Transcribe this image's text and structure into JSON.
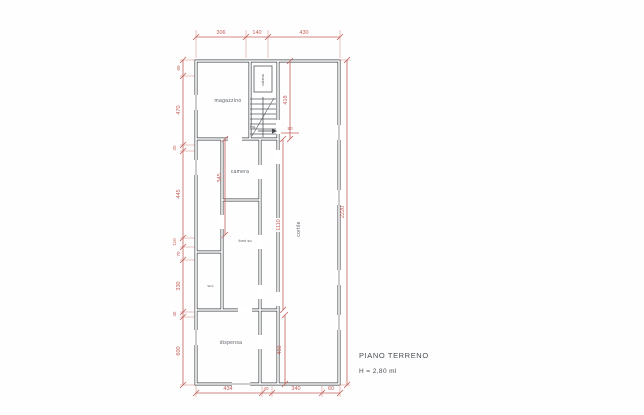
{
  "drawing": {
    "title": "PIANO TERRENO",
    "subtitle": "H = 2,80 ml",
    "rooms": {
      "magazzino": "magazzino",
      "cabina": "cabina",
      "ingresso": "ing.",
      "camera": "camera",
      "forni": "forni so",
      "cortile": "cortile",
      "wc": "w.c.",
      "dispensa": "dispensa"
    },
    "dims": {
      "top": [
        "306",
        "140",
        "430"
      ],
      "left": [
        "60",
        "470",
        "20",
        "445",
        "110",
        "70",
        "330",
        "45",
        "600"
      ],
      "bottom": [
        "434",
        "40",
        "340",
        "60"
      ],
      "right_overall": "2220",
      "stair_bay": "418",
      "camera_depth": "345",
      "corridor_length": "1110",
      "dispensa_depth": "480",
      "entry_width": "90"
    },
    "colors": {
      "dimension_red": "#c2625c",
      "wall_dark": "#3f4246",
      "label_gray": "#5a6066"
    }
  }
}
